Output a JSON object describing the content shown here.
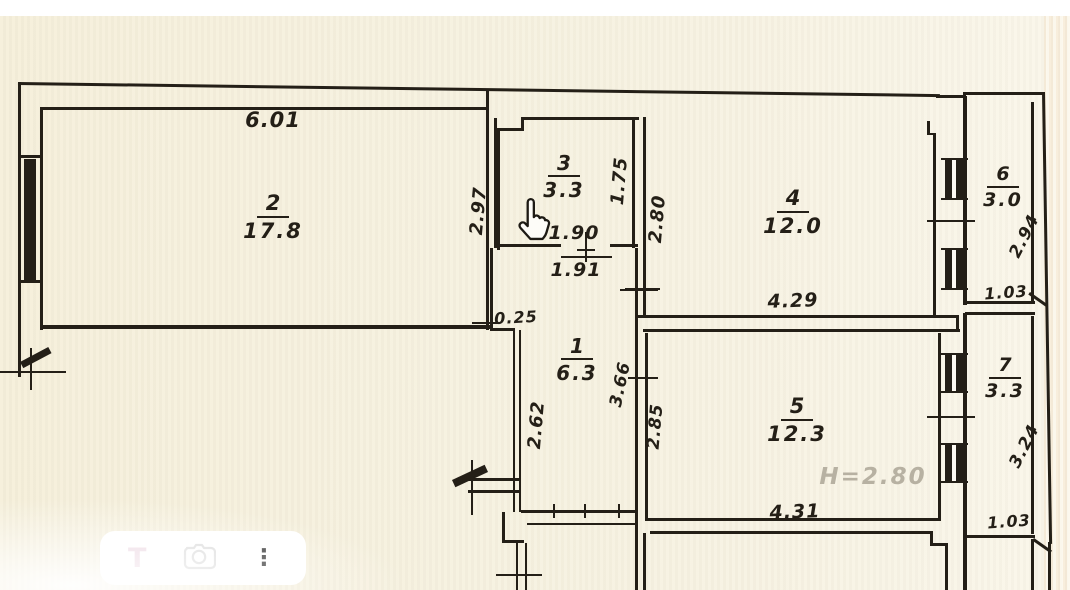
{
  "toolbar": {
    "text_glyph": "T",
    "more_glyph": "⋮",
    "icons": [
      "text-tool",
      "lens-camera",
      "more-options"
    ]
  },
  "cursor": {
    "type": "hand-pointer"
  },
  "plan": {
    "rooms": {
      "r1": {
        "number": "1",
        "area": "6.3"
      },
      "r2": {
        "number": "2",
        "area": "17.8"
      },
      "r3": {
        "number": "3",
        "area": "3.3"
      },
      "r4": {
        "number": "4",
        "area": "12.0"
      },
      "r5": {
        "number": "5",
        "area": "12.3"
      },
      "r6": {
        "number": "6",
        "area": "3.0"
      },
      "r7": {
        "number": "7",
        "area": "3.3"
      }
    },
    "dims": {
      "d601": "6.01",
      "d297": "2.97",
      "d175": "1.75",
      "d190": "1.90",
      "d191": "1.91",
      "d280": "2.80",
      "d429": "4.29",
      "d294": "2.94",
      "d103a": "1.03",
      "d025": "0.25",
      "d262": "2.62",
      "d366": "3.66",
      "d285": "2.85",
      "d431": "4.31",
      "d324": "3.24",
      "d103b": "1.03",
      "height_note": "H=2.80"
    },
    "colors": {
      "paper": "#f6f0dd",
      "ink": "#241f17",
      "faded_ink": "#b7b1a2",
      "toolbar_bg": "#ffffff"
    }
  }
}
